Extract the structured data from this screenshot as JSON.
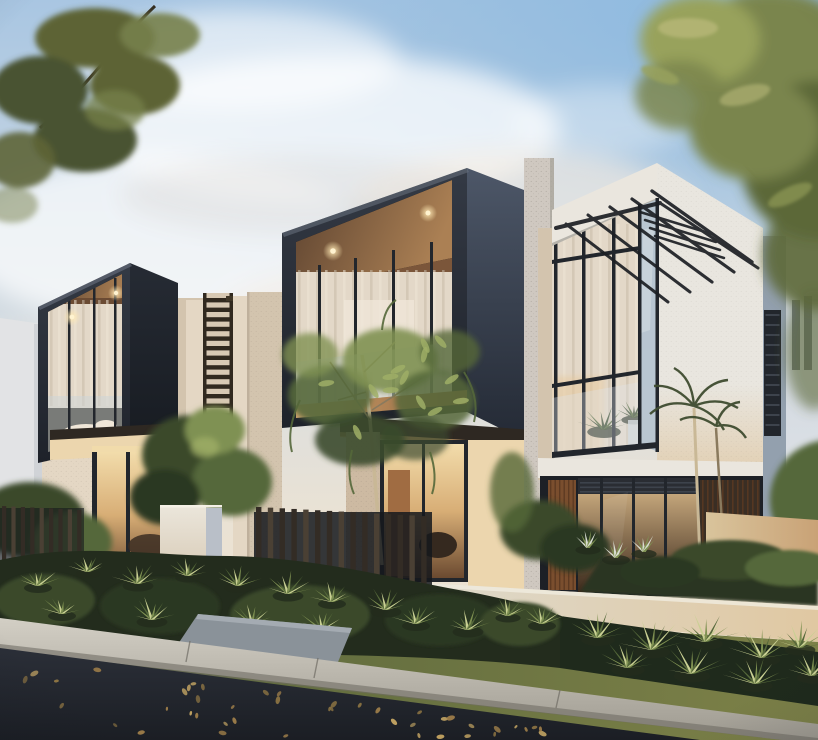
{
  "scene": {
    "type": "photorealistic-architectural-exterior-render",
    "time_of_day": "dusk",
    "subject": "Modern two-storey townhouses at dusk with dark boxed balconies, warm lit interiors, corner glass atrium with black pergola, landscaped front garden beds, timber slat fence, white letterbox pillar, lawn verge, concrete kerb and leaf-strewn asphalt road, framed by pine branches and a feathery tree under a pale blue sky with a small moon",
    "objects": [
      "sky",
      "clouds",
      "moon",
      "pine-branch",
      "tree-canopy",
      "townhouse-left",
      "townhouse-middle",
      "townhouse-right",
      "neighbor-building-left",
      "neighbor-building-right",
      "balcony-box",
      "downlights",
      "louvre-screen",
      "concrete-pillar",
      "corner-glass",
      "pergola-awning",
      "louvre-shutter",
      "balcony-plants",
      "feathery-tree",
      "palm-tree",
      "slat-fence",
      "letterbox-pillar",
      "garden-bed",
      "fern",
      "bromeliad",
      "plume-grass",
      "retaining-wall-warm",
      "retaining-wall-white",
      "lawn",
      "walkway",
      "kerb",
      "asphalt-road",
      "fallen-leaves"
    ],
    "counts": {
      "townhouse_units_visible": 3,
      "balcony_downlights_lit": 4
    }
  },
  "palette": {
    "sky-top": "#a9c6e2",
    "sky-mid": "#d6dde2",
    "sky-low": "#eae2d4",
    "sky-horizon": "#f2e3cc",
    "sky-blue-deep": "#8fbadf",
    "cloud-white": "#ffffff",
    "cloud-warm": "#f6ece2",
    "cloud-shade": "#d8d3d1",
    "moon": "#f8f5ec",
    "box-front-top": "#343a45",
    "box-front-bottom": "#1e222a",
    "box-side-top": "#262b34",
    "box-side-bottom": "#171b21",
    "boxB-side-top": "#4d5768",
    "boxB-side-bottom": "#242a35",
    "frame-highlight": "#6a7280",
    "wood-dark": "#5d4330",
    "wood-lit": "#ab8054",
    "fascia-lit": "#d8a870",
    "fascia-deep": "#8a5f3c",
    "porch-soffit": "#2e2822",
    "downlight-core": "#fff3d0",
    "downlight-glow": "#ffe9b4",
    "curtain-base": "#e3d8c8",
    "stripe-light": "#efe5d5",
    "stripe-dark": "#c9bba7",
    "interior-white": "#efe6d8",
    "mullion": "#22262c",
    "glass-cool": "#b6c4d0",
    "balustrade": "#ccd4d8",
    "warm-top": "#f2dcab",
    "warm-mid": "#d8ae76",
    "warm-deep": "#6b4a30",
    "warmC-top": "#d9b98a",
    "warmC-deep": "#3c2a1c",
    "cream-wall": "#e4d7c4",
    "cream-shadow": "#d3c4ae",
    "cream-deep": "#bfb09c",
    "cream-lit": "#ecd6ae",
    "stone-warm": "#cdbaa2",
    "concrete-speckle": "#cfc8c0",
    "speck-dot": "#6b6258",
    "white-face": "#e9e6df",
    "white-face-warm": "#e2d0b4",
    "fascia-white": "#eae6de",
    "parapet-shadow": "#a9a69e",
    "wood-slat": "#7a4e2e",
    "wood-slat-dark": "#5d3a22",
    "slat-section": "#3a2e24",
    "shutter": "#22262c",
    "shutter-slat": "#3d434c",
    "pergola": "#1c1f24",
    "neighborL": "#e2e3e5",
    "neighborL-shade": "#c9ccd1",
    "neighborR-top": "#c6cfda",
    "neighborR-bottom": "#e3e6e9",
    "neighborR-slot": "#5c6470",
    "midwall-blue": "#93a0ae",
    "screen-bg": "#d8c9b4",
    "rung": "#31291f",
    "pillar-front": "#ebe6db",
    "pillar-side": "#b9bfc8",
    "fence-dark": "#332c25",
    "fence-light": "#4a4034",
    "fence-backdrop": "#14171c",
    "foliage-deep": "#2c3824",
    "foliage-dark": "#3a4a2c",
    "foliage-mid": "#55683a",
    "foliage-light": "#7f9152",
    "foliage-bright": "#9fae66",
    "fern-pale": "#c9d093",
    "plume": "#d8dcd0",
    "trunk-lit": "#c9b896",
    "trunk-shade": "#8a7a5e",
    "palm-green": "#3f4c30",
    "bed-dark": "#232c1d",
    "bed-right": "#1f2a1c",
    "groundcover": "#2a3522",
    "lawn-lit": "#7d8148",
    "lawn-deep": "#55633a",
    "wall-warm-l": "#d9c49c",
    "wall-warm-r": "#c9a276",
    "lowwall-l": "#dedacd",
    "lowwall-r": "#e0c8a2",
    "path-gray": "#8a9299",
    "kerb-top": "#d3cfc5",
    "kerb-bottom": "#9c988e",
    "kerb-shadow": "#6f6c64",
    "road-top": "#2b2f38",
    "road-deep": "#1b1e24",
    "leaf-1": "#c0a262",
    "leaf-2": "#a8854c",
    "leaf-3": "#8a7242",
    "pine-dark": "#4a5230",
    "pine-mid": "#5d6436",
    "pine-light": "#76804a",
    "branch": "#342d20",
    "treeR-dark": "#5c6838",
    "treeR-mid": "#7a854e",
    "treeR-light": "#98a25c",
    "treeR-gold": "#b8b878"
  }
}
